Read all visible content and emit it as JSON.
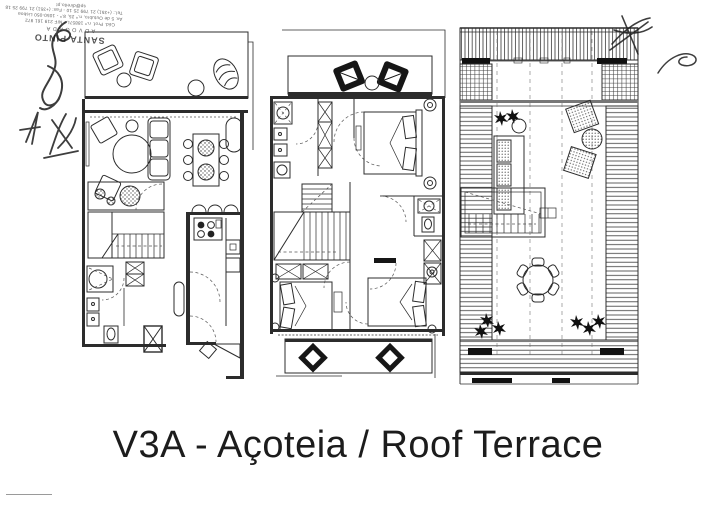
{
  "colors": {
    "paper": "#ffffff",
    "ink": "#2c2c2c",
    "caption_ink": "#1c1c1c"
  },
  "caption": {
    "text": "V3A - Açoteia / Roof Terrace"
  },
  "stamp": {
    "name": "SANTA PINTO",
    "title": "ADVOGADA",
    "registration": "Céd. Prof. n.º 18857L - NIF 219 161 972",
    "address": "Av. 5 de Outubro, n.º 25, 8.º - 1050-050 Lisboa",
    "phone": "Tel.: (+351) 21 799 25 10 - Fax: (+351) 21 799 25 18",
    "email": "sp@direito.pt"
  }
}
